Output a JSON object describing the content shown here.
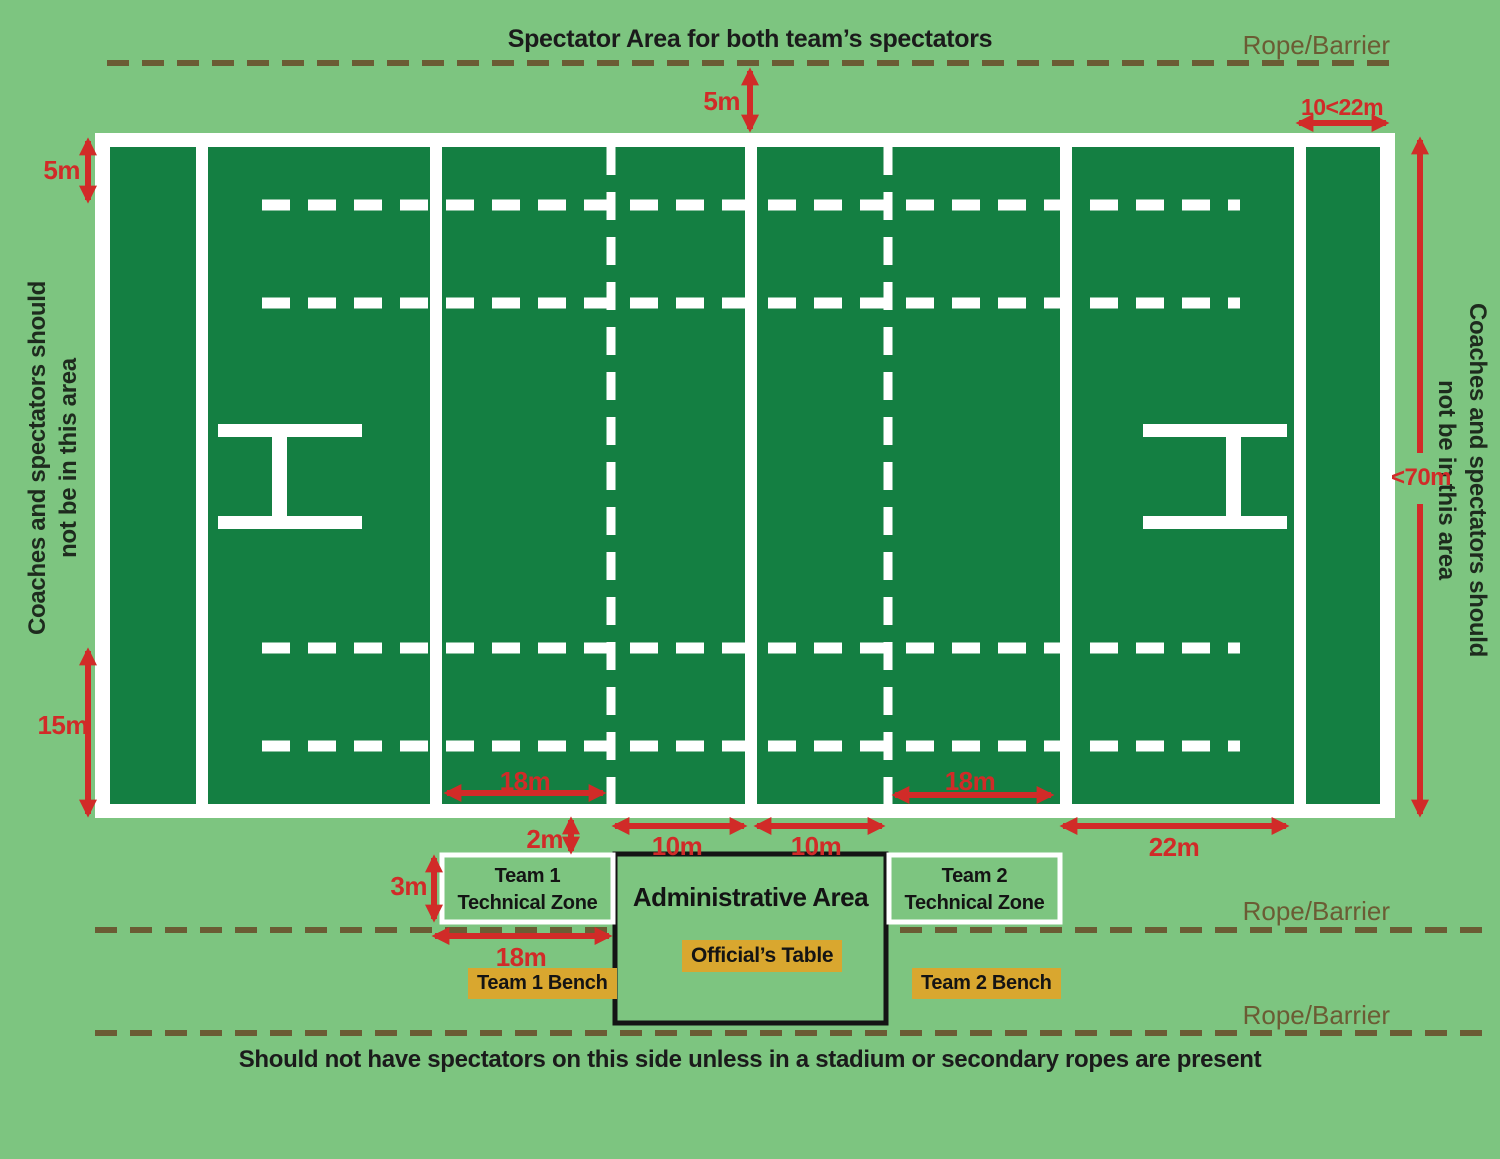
{
  "colors": {
    "background_green": "#7DC580",
    "field_green": "#147F42",
    "line_white": "#FFFFFF",
    "dimension_red": "#D12B28",
    "rope_brown": "#6B5C34",
    "bench_gold": "#D9A72F",
    "text_dark": "#1B1B1B"
  },
  "labels": {
    "title": "Spectator Area for both team’s spectators",
    "rope_barrier": "Rope/Barrier",
    "footer": "Should not have spectators on this side unless in a stadium or secondary ropes are present",
    "side_note_line1": "Coaches and spectators should",
    "side_note_line2": "not be in this area"
  },
  "dimensions": {
    "top_gap_5m": "5m",
    "ingoal_depth": "10<22m",
    "left_5m": "5m",
    "left_15m": "15m",
    "field_width_70m": "<70m",
    "gap_2m": "2m",
    "zone_height_3m": "3m",
    "ten_m_left": "10m",
    "ten_m_right": "10m",
    "twenty_two_m": "22m",
    "eighteen_m_inner_left": "18m",
    "eighteen_m_inner_right": "18m",
    "eighteen_m_zone": "18m"
  },
  "zones": {
    "team1_zone_line1": "Team 1",
    "team1_zone_line2": "Technical Zone",
    "team2_zone_line1": "Team 2",
    "team2_zone_line2": "Technical Zone",
    "admin_area": "Administrative Area",
    "officials_table": "Official’s Table",
    "team1_bench": "Team 1 Bench",
    "team2_bench": "Team 2 Bench"
  }
}
